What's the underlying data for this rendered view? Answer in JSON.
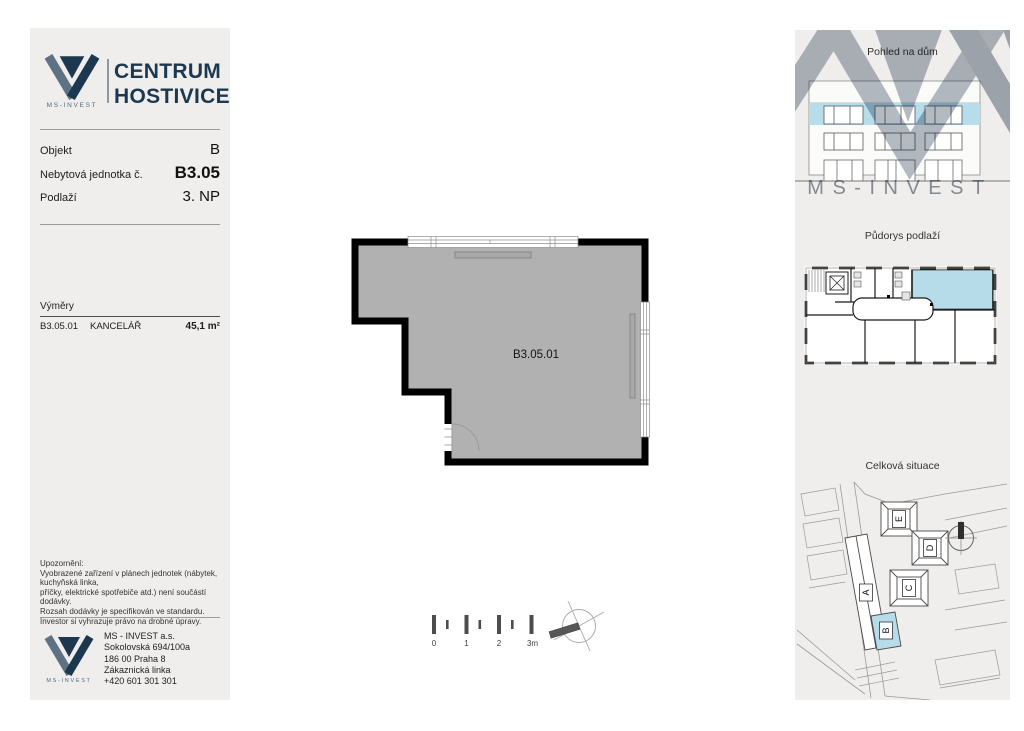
{
  "left_panel": {
    "logo_caption": "MS-INVEST",
    "title1": "CENTRUM",
    "title2": "HOSTIVICE",
    "info_rows": [
      {
        "label": "Objekt",
        "value": "B"
      },
      {
        "label": "Nebytová jednotka č.",
        "value": "B3.05"
      },
      {
        "label": "Podlaží",
        "value": "3. NP"
      }
    ],
    "areas": {
      "heading": "Výměry",
      "rows": [
        {
          "code": "B3.05.01",
          "name": "KANCELÁŘ",
          "area": "45,1 m²"
        }
      ]
    },
    "disclaimer": {
      "heading": "Upozornění:",
      "lines": [
        "Vyobrazené zařízení v plánech jednotek (nábytek, kuchyňská linka,",
        "příčky, elektrické spotřebiče atd.) není součástí dodávky.",
        "Rozsah dodávky je specifikován ve standardu.",
        "Investor si vyhrazuje právo na drobné úpravy."
      ]
    },
    "footer": {
      "logo_caption": "MS-INVEST",
      "lines": [
        "MS - INVEST a.s.",
        "Sokolovská 694/100a",
        "186 00 Praha 8",
        "Zákaznická linka",
        "+420 601 301 301"
      ]
    }
  },
  "plan": {
    "room_label": "B3.05.01",
    "scale_labels": [
      "0",
      "1",
      "2",
      "3m"
    ]
  },
  "right_panel": {
    "watermark_text": "MS-INVEST",
    "sections": [
      {
        "title": "Pohled na dům"
      },
      {
        "title": "Půdorys podlaží"
      },
      {
        "title": "Celková situace"
      }
    ],
    "building_labels": [
      "A",
      "B",
      "C",
      "D",
      "E"
    ]
  },
  "colors": {
    "navy": "#1b3850",
    "panel_bg": "#efeeec",
    "highlight_blue": "#b5dce8",
    "room_gray": "#b1b1b1"
  }
}
